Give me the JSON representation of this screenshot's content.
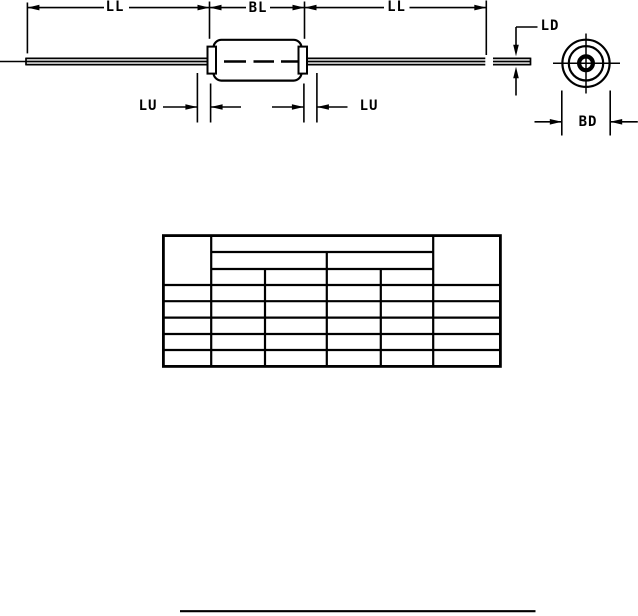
{
  "page": {
    "background": "#ffffff",
    "line_color": "#000000"
  },
  "figure": {
    "description": "axial-lead component outline drawing with end view",
    "labels": {
      "ll_left": "LL",
      "bl": "BL",
      "ll_right": "LL",
      "lu_left": "LU",
      "lu_right": "LU",
      "ld": "LD",
      "bd": "BD"
    }
  },
  "table": {
    "columns": 6,
    "header_levels": 3,
    "data_rows": 5,
    "cells": []
  }
}
